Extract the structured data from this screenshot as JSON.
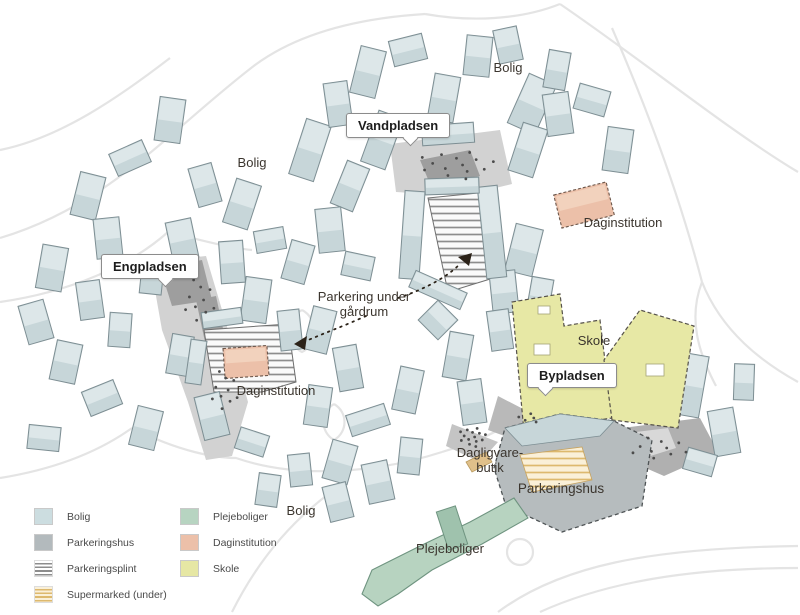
{
  "callouts": {
    "vandpladsen": "Vandpladsen",
    "engpladsen": "Engpladsen",
    "bypladsen": "Bypladsen"
  },
  "labels": {
    "bolig": "Bolig",
    "skole": "Skole",
    "daginstitution": "Daginstitution",
    "parkeringshus": "Parkeringshus",
    "plejeboliger": "Plejeboliger",
    "dagligvarebutik_line1": "Dagligvare-",
    "dagligvarebutik_line2": "butik",
    "parkering_note_line1": "Parkering under",
    "parkering_note_line2": "gårdrum"
  },
  "legend": {
    "columns": [
      {
        "items": [
          {
            "label": "Bolig",
            "color": "#ccdde0",
            "swatch": "solid"
          },
          {
            "label": "Parkeringshus",
            "color": "#b3babd",
            "swatch": "solid"
          },
          {
            "label": "Parkeringsplint",
            "color": "#8d8d8d",
            "swatch": "stripes-grey"
          },
          {
            "label": "Supermarked (under)",
            "color": "#ddb96e",
            "swatch": "stripes-yellow"
          }
        ]
      },
      {
        "items": [
          {
            "label": "Plejeboliger",
            "color": "#b7d4c1",
            "swatch": "solid"
          },
          {
            "label": "Daginstitution",
            "color": "#ecc0a9",
            "swatch": "solid"
          },
          {
            "label": "Skole",
            "color": "#e6e7a4",
            "swatch": "solid"
          }
        ]
      }
    ]
  },
  "colors": {
    "background": "#ffffff",
    "bolig_fill": "#c7d6d9",
    "bolig_roof": "#dde7e9",
    "bolig_stroke": "#7d8e93",
    "plaza": "#d2d2d2",
    "plaza_dark": "#9e9e9e",
    "road": "#e4e4e4",
    "skole": "#e7e8a5",
    "parkeringshus": "#b6bcbe",
    "plejeboliger": "#b7d3c0",
    "daginstitution": "#ecc0a9",
    "stripe_grey": "#8d8d8d",
    "supermarked_stripe": "#ddb96e",
    "arrow": "#2b2218"
  }
}
